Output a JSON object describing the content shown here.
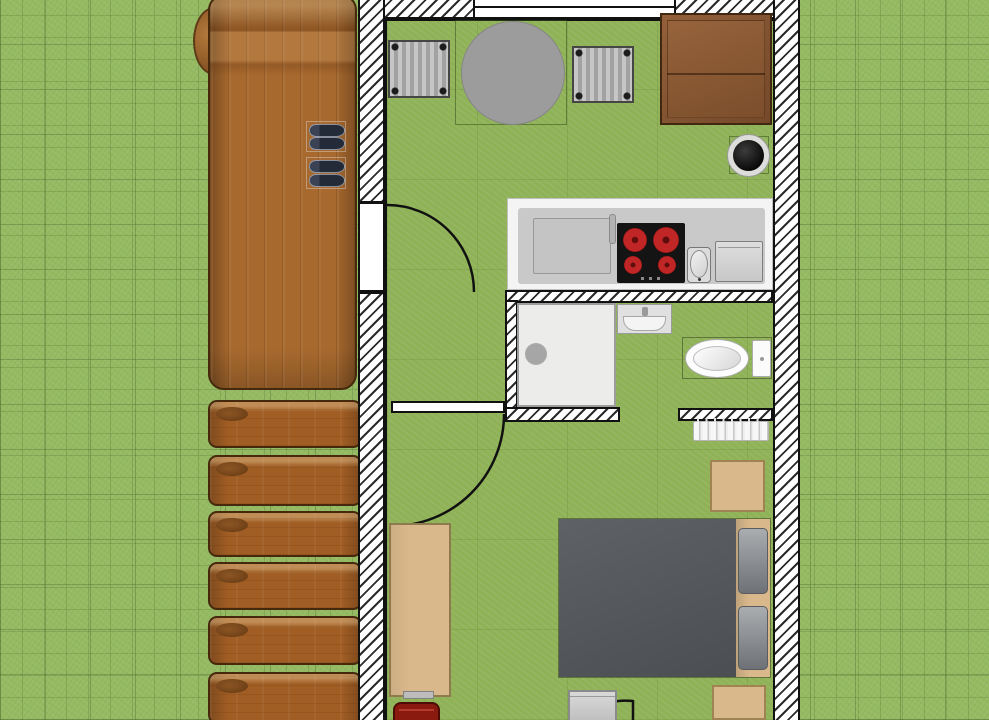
{
  "meta": {
    "type": "floor-plan-render",
    "canvas": {
      "width": 989,
      "height": 720
    }
  },
  "colors": {
    "grass": "#94ba62",
    "floor": "#8fb257",
    "outline": "#111111",
    "wall_fill": "#ffffff",
    "wall_hatch": "#2b2b2b",
    "wood": "#a8692e",
    "wood_border": "#46290c",
    "step": "#a05d24",
    "couch": "#8a5733",
    "couch_border": "#3f2710",
    "table_gray": "#9c9c9c",
    "chair_gray": "#b5b5b5",
    "counter_white": "#f4f4f4",
    "counter_gray": "#c9c9c9",
    "cooktop_black": "#141414",
    "burner_red": "#c12626",
    "fixture_white": "#f7f7f7",
    "bed_gray": "#55585c",
    "pillow_gray": "#9a9da0",
    "tan": "#d9b88b",
    "tan_border": "#a08353",
    "chair_red": "#8a1a10",
    "shoe_dark": "#242b38"
  },
  "outdoor": {
    "ground": "lawn-with-tile-grid",
    "deck": "wood-terrace",
    "deck_steps_count": 6,
    "shoe_pairs_on_deck": 2
  },
  "rooms": [
    {
      "name": "kitchen-dining",
      "objects": [
        "dining-table-round",
        "dining-chair-left",
        "dining-chair-right",
        "sofa",
        "plant-pot",
        "kitchen-counter",
        "worktop",
        "counter-faucet",
        "cooktop",
        "cooktop-burners-4",
        "kitchen-sink",
        "kitchen-appliance"
      ]
    },
    {
      "name": "bathroom",
      "objects": [
        "shower-cabin",
        "shower-drain",
        "washbasin",
        "toilet",
        "toilet-tank",
        "radiator"
      ]
    },
    {
      "name": "bedroom",
      "objects": [
        "double-bed",
        "bed-pillow-left",
        "bed-pillow-right",
        "headboard",
        "nightstand-upper",
        "nightstand-lower",
        "desk",
        "keyboard-tray",
        "desk-chair-red",
        "dresser"
      ]
    }
  ],
  "openings": {
    "doors": [
      "entry-door",
      "bedroom-door",
      "bottom-door"
    ],
    "windows": [
      "kitchen-window"
    ]
  }
}
